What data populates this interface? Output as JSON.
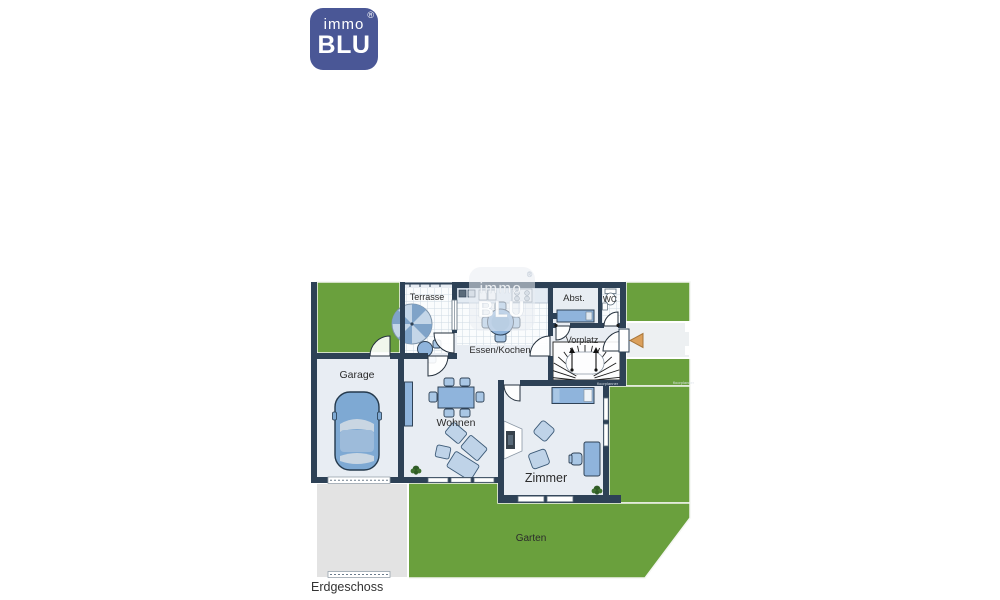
{
  "logo": {
    "immo": "immo",
    "blu": "BLU",
    "reg": "®",
    "color": "#4a5796"
  },
  "watermark": {
    "immo": "immo",
    "blu": "BLU",
    "reg": "®"
  },
  "plan": {
    "floor_label": "Erdgeschoss",
    "rooms": {
      "terrasse": "Terrasse",
      "essen_kochen": "Essen/Kochen",
      "abst": "Abst.",
      "wc": "WC",
      "vorplatz": "Vorplatz",
      "garage": "Garage",
      "wohnen": "Wohnen",
      "zimmer": "Zimmer",
      "garten": "Garten"
    },
    "fine_print": "floorplanner",
    "colors": {
      "wall": "#2d4156",
      "garden_green": "#6aa03d",
      "room_floor": "#e8edf3",
      "furniture_blue": "#8fb4dc",
      "driveway_gray": "#e3e3e3",
      "entry_arrow_orange": "#dba05c"
    }
  }
}
